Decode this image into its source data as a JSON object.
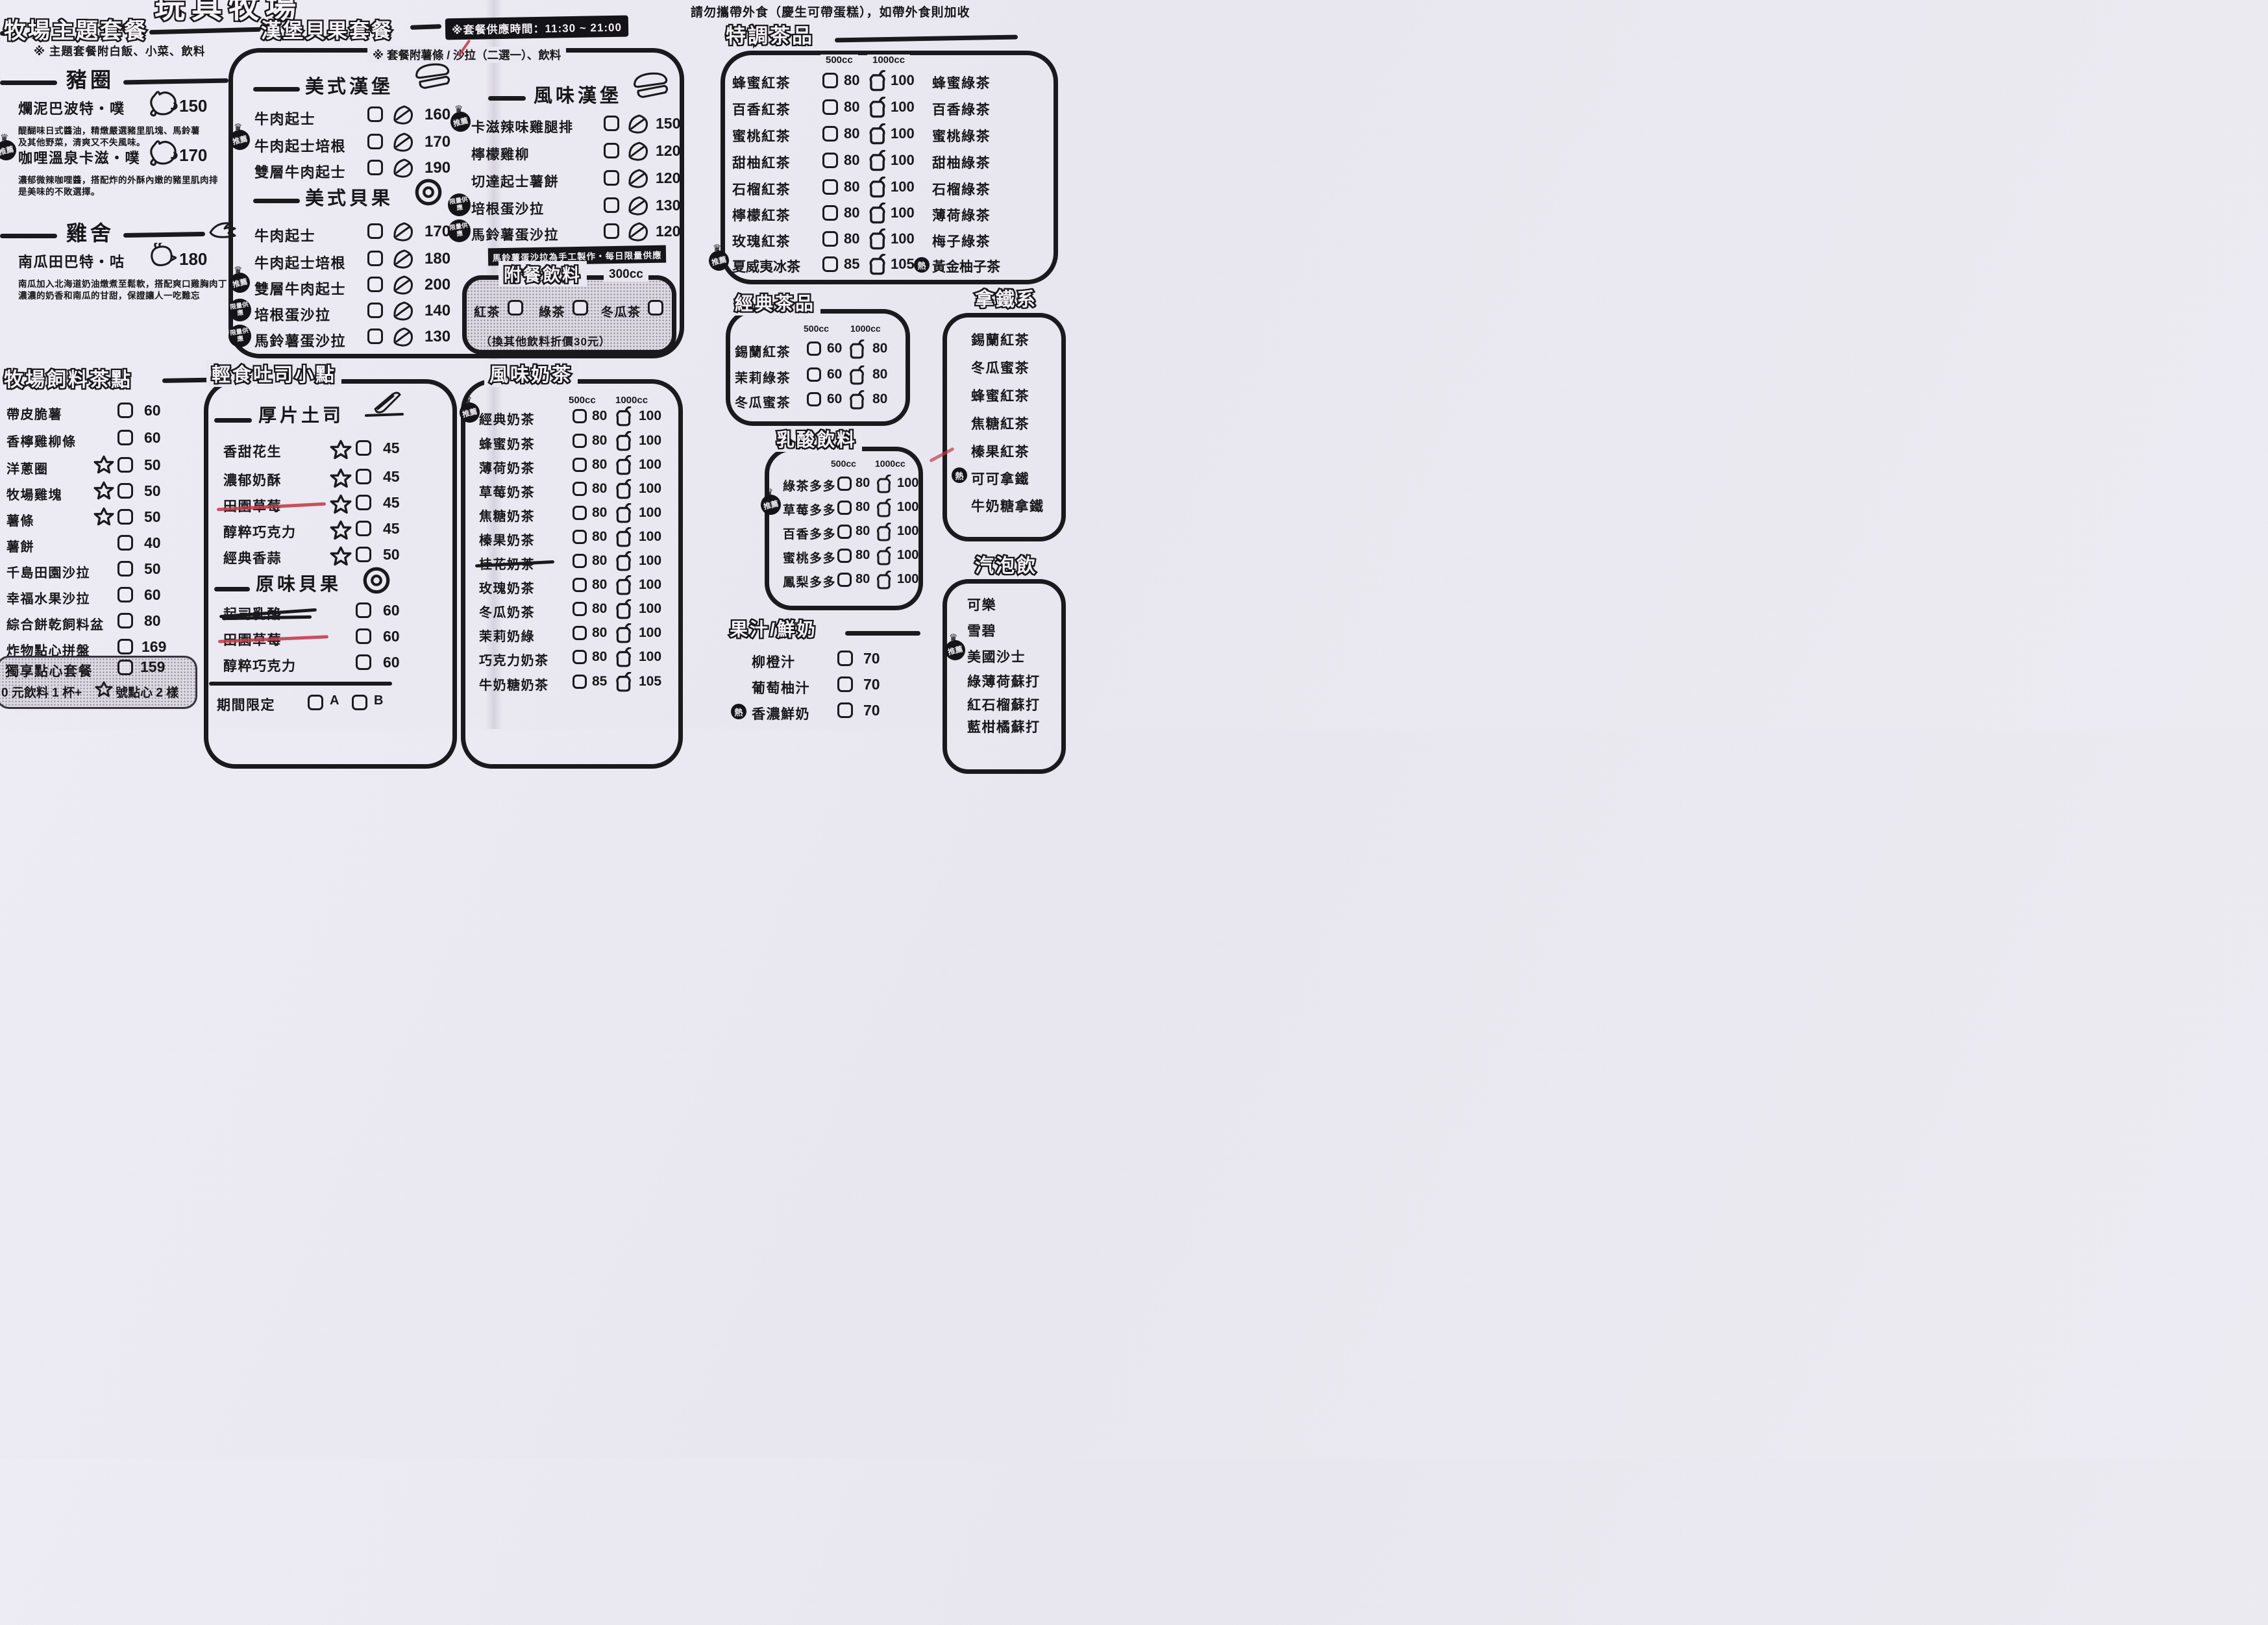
{
  "page": {
    "bg": "#e9e7ef",
    "ink": "#17161a",
    "red": "#c23b47",
    "title_partial": "玩具牧場",
    "no_outside_food": "請勿攜帶外食（慶生可帶蛋糕），如帶外食則加收",
    "service_time": "※套餐供應時間：11:30 ~ 21:00"
  },
  "badges": {
    "rec": "推薦",
    "lim": "限量供應",
    "hot": "熱",
    "crown": "♛"
  },
  "sizes": {
    "s500": "500cc",
    "s1000": "1000cc"
  },
  "theme": {
    "title": "牧場主題套餐",
    "note": "※ 主題套餐附白飯、小菜、飲料",
    "pig": {
      "title": "豬圈",
      "i0": {
        "name": "爛泥巴波特・噗",
        "price": "150",
        "d1": "醍醐味日式醬油，精燉嚴選豬里肌塊、馬鈴薯",
        "d2": "及其他野菜，清爽又不失風味。"
      },
      "i1": {
        "name": "咖哩溫泉卡滋・噗",
        "price": "170",
        "d1": "濃郁微辣咖哩醬，搭配炸的外酥內嫩的豬里肌肉排",
        "d2": "是美味的不敗選擇。"
      }
    },
    "hen": {
      "title": "雞舍",
      "i0": {
        "name": "南瓜田巴特・咕",
        "price": "180",
        "d1": "南瓜加入北海道奶油燉煮至鬆軟，搭配爽口雞胸肉丁",
        "d2": "濃濃的奶香和南瓜的甘甜，保證讓人一吃難忘"
      }
    }
  },
  "burger": {
    "title": "漢堡貝果套餐",
    "note": "※ 套餐附薯條 / 沙拉（二選一）、飲料",
    "american_burger": {
      "title": "美式漢堡",
      "items": [
        {
          "name": "牛肉起士",
          "price": "160"
        },
        {
          "name": "牛肉起士培根",
          "price": "170"
        },
        {
          "name": "雙層牛肉起士",
          "price": "190"
        }
      ]
    },
    "american_bagel": {
      "title": "美式貝果",
      "items": [
        {
          "name": "牛肉起士",
          "price": "170"
        },
        {
          "name": "牛肉起士培根",
          "price": "180"
        },
        {
          "name": "雙層牛肉起士",
          "price": "200"
        },
        {
          "name": "培根蛋沙拉",
          "price": "140"
        },
        {
          "name": "馬鈴薯蛋沙拉",
          "price": "130"
        }
      ]
    },
    "flavor_burger": {
      "title": "風味漢堡",
      "note": "馬鈴薯蛋沙拉為手工製作・每日限量供應",
      "items": [
        {
          "name": "卡滋辣味雞腿排",
          "price": "150"
        },
        {
          "name": "檸檬雞柳",
          "price": "120"
        },
        {
          "name": "切達起士薯餅",
          "price": "120"
        },
        {
          "name": "培根蛋沙拉",
          "price": "130"
        },
        {
          "name": "馬鈴薯蛋沙拉",
          "price": "120"
        }
      ]
    },
    "set_drink": {
      "title": "附餐飲料",
      "size": "300cc",
      "o0": "紅茶",
      "o1": "綠茶",
      "o2": "冬瓜茶",
      "note": "（換其他飲料折價30元）"
    }
  },
  "snacks": {
    "title": "牧場飼料茶點",
    "items": [
      {
        "name": "帶皮脆薯",
        "price": "60"
      },
      {
        "name": "香檸雞柳條",
        "price": "60"
      },
      {
        "name": "洋蔥圈",
        "price": "50"
      },
      {
        "name": "牧場雞塊",
        "price": "50"
      },
      {
        "name": "薯條",
        "price": "50"
      },
      {
        "name": "薯餅",
        "price": "40"
      },
      {
        "name": "千島田園沙拉",
        "price": "50"
      },
      {
        "name": "幸福水果沙拉",
        "price": "60"
      },
      {
        "name": "綜合餅乾飼料盆",
        "price": "80"
      },
      {
        "name": "炸物點心拼盤",
        "price": "169"
      }
    ],
    "combo": {
      "name": "獨享點心套餐",
      "price": "159",
      "note_pre": "0 元飲料 1 杯+",
      "note_post": "號點心 2 樣"
    }
  },
  "toast": {
    "title": "輕食吐司小點",
    "thick": {
      "title": "厚片土司",
      "items": [
        {
          "name": "香甜花生",
          "price": "45"
        },
        {
          "name": "濃郁奶酥",
          "price": "45"
        },
        {
          "name": "田園草莓",
          "price": "45"
        },
        {
          "name": "醇粹巧克力",
          "price": "45"
        },
        {
          "name": "經典香蒜",
          "price": "50"
        }
      ]
    },
    "bagel": {
      "title": "原味貝果",
      "items": [
        {
          "name": "起司乳酪",
          "price": "60"
        },
        {
          "name": "田園草莓",
          "price": "60"
        },
        {
          "name": "醇粹巧克力",
          "price": "60"
        }
      ]
    },
    "limited": {
      "label": "期間限定",
      "a": "A",
      "b": "B"
    }
  },
  "milk_tea": {
    "title": "風味奶茶",
    "items": [
      {
        "name": "經典奶茶",
        "p500": "80",
        "p1000": "100"
      },
      {
        "name": "蜂蜜奶茶",
        "p500": "80",
        "p1000": "100"
      },
      {
        "name": "薄荷奶茶",
        "p500": "80",
        "p1000": "100"
      },
      {
        "name": "草莓奶茶",
        "p500": "80",
        "p1000": "100"
      },
      {
        "name": "焦糖奶茶",
        "p500": "80",
        "p1000": "100"
      },
      {
        "name": "榛果奶茶",
        "p500": "80",
        "p1000": "100"
      },
      {
        "name": "桂花奶茶",
        "p500": "80",
        "p1000": "100"
      },
      {
        "name": "玫瑰奶茶",
        "p500": "80",
        "p1000": "100"
      },
      {
        "name": "冬瓜奶茶",
        "p500": "80",
        "p1000": "100"
      },
      {
        "name": "茉莉奶綠",
        "p500": "80",
        "p1000": "100"
      },
      {
        "name": "巧克力奶茶",
        "p500": "80",
        "p1000": "100"
      },
      {
        "name": "牛奶糖奶茶",
        "p500": "85",
        "p1000": "105"
      }
    ]
  },
  "special_tea": {
    "title": "特調茶品",
    "rows": [
      {
        "left": "蜂蜜紅茶",
        "p500": "80",
        "p1000": "100",
        "right": "蜂蜜綠茶"
      },
      {
        "left": "百香紅茶",
        "p500": "80",
        "p1000": "100",
        "right": "百香綠茶"
      },
      {
        "left": "蜜桃紅茶",
        "p500": "80",
        "p1000": "100",
        "right": "蜜桃綠茶"
      },
      {
        "left": "甜柚紅茶",
        "p500": "80",
        "p1000": "100",
        "right": "甜柚綠茶"
      },
      {
        "left": "石榴紅茶",
        "p500": "80",
        "p1000": "100",
        "right": "石榴綠茶"
      },
      {
        "left": "檸檬紅茶",
        "p500": "80",
        "p1000": "100",
        "right": "薄荷綠茶"
      },
      {
        "left": "玫瑰紅茶",
        "p500": "80",
        "p1000": "100",
        "right": "梅子綠茶"
      },
      {
        "left": "夏威夷冰茶",
        "p500": "85",
        "p1000": "105",
        "right": "黃金柚子茶"
      }
    ]
  },
  "classic_tea": {
    "title": "經典茶品",
    "rows": [
      {
        "name": "錫蘭紅茶",
        "p500": "60",
        "p1000": "80"
      },
      {
        "name": "茉莉綠茶",
        "p500": "60",
        "p1000": "80"
      },
      {
        "name": "冬瓜蜜茶",
        "p500": "60",
        "p1000": "80"
      }
    ]
  },
  "yogurt": {
    "title": "乳酸飲料",
    "rows": [
      {
        "name": "綠茶多多",
        "p500": "80",
        "p1000": "100"
      },
      {
        "name": "草莓多多",
        "p500": "80",
        "p1000": "100"
      },
      {
        "name": "百香多多",
        "p500": "80",
        "p1000": "100"
      },
      {
        "name": "蜜桃多多",
        "p500": "80",
        "p1000": "100"
      },
      {
        "name": "鳳梨多多",
        "p500": "80",
        "p1000": "100"
      }
    ]
  },
  "juice": {
    "title": "果汁/鮮奶",
    "items": [
      {
        "name": "柳橙汁",
        "price": "70"
      },
      {
        "name": "葡萄柚汁",
        "price": "70"
      },
      {
        "name": "香濃鮮奶",
        "price": "70"
      }
    ]
  },
  "latte": {
    "title": "拿鐵系",
    "items": [
      {
        "name": "錫蘭紅茶"
      },
      {
        "name": "冬瓜蜜茶"
      },
      {
        "name": "蜂蜜紅茶"
      },
      {
        "name": "焦糖紅茶"
      },
      {
        "name": "榛果紅茶"
      },
      {
        "name": "可可拿鐵"
      },
      {
        "name": "牛奶糖拿鐵"
      }
    ]
  },
  "soda": {
    "title": "汽泡飲",
    "items": [
      {
        "name": "可樂"
      },
      {
        "name": "雪碧"
      },
      {
        "name": "美國沙士"
      },
      {
        "name": "綠薄荷蘇打"
      },
      {
        "name": "紅石榴蘇打"
      },
      {
        "name": "藍柑橘蘇打"
      }
    ]
  }
}
